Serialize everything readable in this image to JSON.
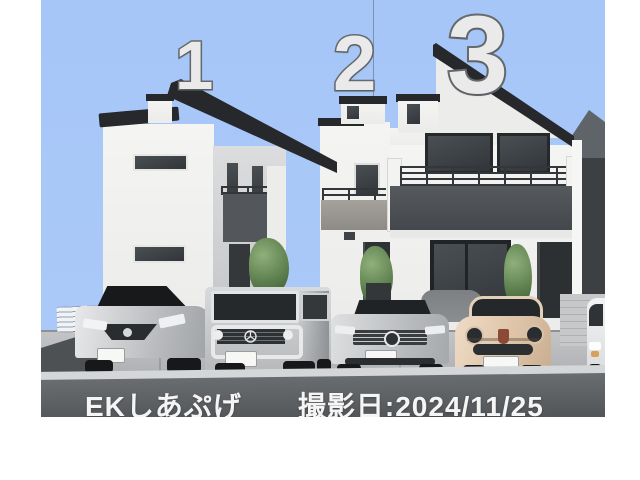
{
  "photo": {
    "description": "CG exterior rendering of three newly built two-storey houses with cars parked in front",
    "units": [
      {
        "number": "1"
      },
      {
        "number": "2"
      },
      {
        "number": "3"
      }
    ],
    "watermark": {
      "prefix": "EKしあぷげ",
      "date_label": "撮影日:2024/11/25"
    },
    "vehicles": [
      "silver hatchback",
      "silver boxy SUV (G-class style)",
      "silver sedan",
      "beige compact car (Fiat 500 style)",
      "white car (partial, right edge)"
    ],
    "colors": {
      "sky": "#a8c8f8",
      "roof": "#26282b",
      "wall": "#f0f0ee",
      "balcony_fascia": "#4a4d51",
      "driveway": "#b4b6b9",
      "road": "#5e6164",
      "number_fill": "#eaeaea",
      "number_outline": "#686c70",
      "fiat_body": "#e3cbb2"
    }
  }
}
